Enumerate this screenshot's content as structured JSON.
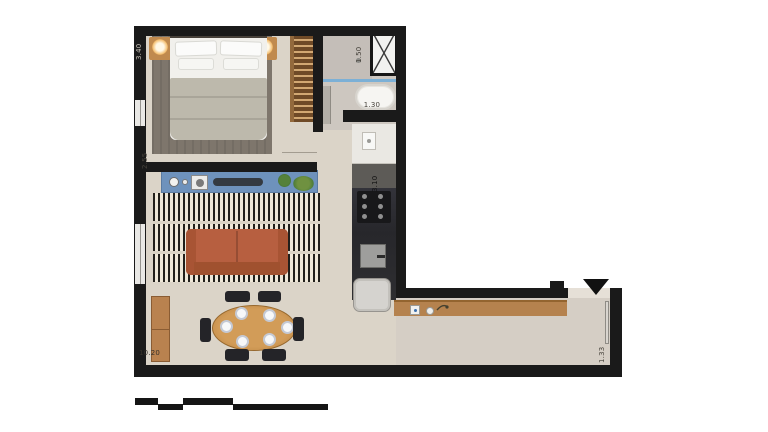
{
  "labels": {
    "bedroom_width": "3.40",
    "living_wall": "2.55",
    "shower_width": "1.50",
    "bathtub_length": "1.30",
    "kitchen_length": "3.10",
    "apartment_length": "10.20",
    "entry_width": "1.33"
  },
  "icons": {
    "entry_marker": "triangle-down"
  },
  "colors": {
    "wall": "#1a1a1a",
    "floor": "#dbd4c8",
    "bathroom_floor": "#cdc7c0",
    "sofa": "#b75f40",
    "media_console": "#6e92bc",
    "wood_furniture": "#b5824e",
    "glass_partition": "#7cb0d6",
    "rug_stripe_dark": "#211f1b",
    "rug_stripe_light": "#eee7d8"
  }
}
